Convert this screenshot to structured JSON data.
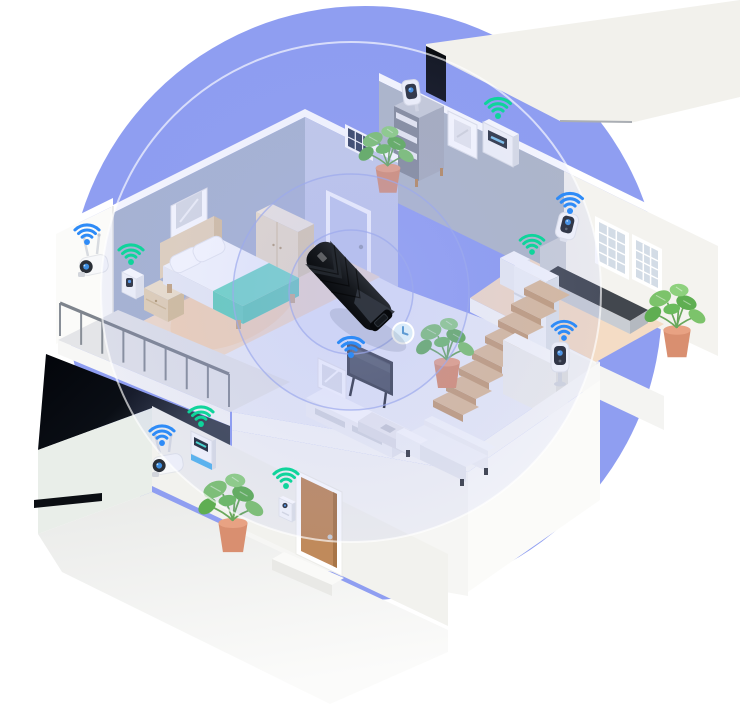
{
  "meta": {
    "type": "isometric-illustration",
    "subject": "smart home Wi-Fi coverage provided by a USB Wi-Fi adapter",
    "canvas": {
      "width": 740,
      "height": 720
    }
  },
  "palette": {
    "background": "#FFFFFF",
    "coverage_backdrop": "#8F9EF1",
    "coverage_tint": "#96A3F2",
    "wifi_blue": "#2E8BF7",
    "wifi_green": "#0FD49B",
    "adapter_body": "#15181D",
    "wall_gray": "#B1B9C6",
    "wall_blue": "#A9B5CF",
    "wall_lavender": "#C7CEE9",
    "wall_offwhite": "#F2F1EC",
    "floor_main": "#ECEEF6",
    "floor_wood": "#F5DEC7",
    "floor_kitchen": "#F4DCC5",
    "accent_teal": "#6FD9C3",
    "plant_green": "#7CC36B",
    "pot_terracotta": "#D98F70",
    "stair_tan": "#D9B897",
    "door_brown": "#C08A5B",
    "clock_face": "#D9EAF9"
  },
  "hero_device": {
    "id": "usb-wifi-adapter",
    "label": "USB Wi-Fi adapter",
    "position": {
      "x": 349,
      "y": 286
    },
    "rotation_deg": 47
  },
  "coverage": {
    "backdrop": {
      "cx": 365,
      "cy": 303,
      "r": 297
    },
    "center": {
      "x": 351,
      "y": 292
    },
    "ring_radii": [
      62,
      118
    ],
    "outer_radius": 250
  },
  "wall_clock": {
    "x": 403,
    "y": 333,
    "r": 10.5
  },
  "stairs": {
    "count": 8,
    "origin": {
      "x": 449,
      "y": 392
    },
    "step_dx": 13,
    "step_dy": -16
  },
  "balcony_railing": {
    "x0": 60,
    "y0": 336,
    "x1": 229,
    "y1": 407,
    "posts": 9,
    "height": 33
  },
  "devices": [
    {
      "id": "balcony-outdoor-camera",
      "label": "outdoor security camera",
      "room": "balcony",
      "wifi": "blue",
      "wifi_x": 87,
      "wifi_y": 242,
      "scale": 0.92
    },
    {
      "id": "balcony-motion-sensor",
      "label": "motion sensor",
      "room": "balcony",
      "wifi": "green",
      "wifi_x": 131,
      "wifi_y": 262,
      "scale": 0.92
    },
    {
      "id": "shelf-indoor-camera",
      "label": "indoor camera on shelf",
      "room": "upper-landing",
      "wifi": null
    },
    {
      "id": "wall-keypad",
      "label": "smart thermostat keypad",
      "room": "upper-landing",
      "wifi": "green",
      "wifi_x": 498,
      "wifi_y": 116,
      "scale": 0.95
    },
    {
      "id": "kitchen-corner-camera",
      "label": "security camera",
      "room": "kitchen",
      "wifi": "blue",
      "wifi_x": 570,
      "wifi_y": 211,
      "scale": 0.95
    },
    {
      "id": "refrigerator",
      "label": "smart refrigerator",
      "room": "kitchen",
      "wifi": "green",
      "wifi_x": 532,
      "wifi_y": 252,
      "scale": 0.9
    },
    {
      "id": "stair-ledge-camera",
      "label": "indoor camera on ledge",
      "room": "living-room",
      "wifi": "blue",
      "wifi_x": 564,
      "wifi_y": 338,
      "scale": 0.9
    },
    {
      "id": "smart-tv",
      "label": "smart TV",
      "room": "living-room",
      "wifi": "blue",
      "wifi_x": 351,
      "wifi_y": 355,
      "scale": 0.95
    },
    {
      "id": "entrance-outdoor-camera",
      "label": "outdoor security camera",
      "room": "entrance",
      "wifi": "blue",
      "wifi_x": 162,
      "wifi_y": 443,
      "scale": 0.92
    },
    {
      "id": "entrance-alarm-panel",
      "label": "smart alarm panel",
      "room": "entrance",
      "wifi": "green",
      "wifi_x": 201,
      "wifi_y": 424,
      "scale": 0.92
    },
    {
      "id": "video-doorbell",
      "label": "video doorbell",
      "room": "entrance",
      "wifi": "green",
      "wifi_x": 286,
      "wifi_y": 486,
      "scale": 0.92
    }
  ],
  "rooms": [
    {
      "id": "bedroom",
      "contents": [
        "double bed with teal blanket",
        "two pillows",
        "headboard",
        "nightstand",
        "wardrobe",
        "wall picture frame",
        "dark window"
      ]
    },
    {
      "id": "hallway",
      "contents": [
        "bedroom door",
        "wall clock",
        "USB Wi-Fi adapter",
        "potted plant",
        "staircase"
      ]
    },
    {
      "id": "upper-landing",
      "contents": [
        "shelf unit",
        "indoor camera on shelf",
        "framed picture",
        "wall keypad",
        "dark doorway",
        "potted plant"
      ]
    },
    {
      "id": "kitchen",
      "contents": [
        "refrigerator",
        "wall cabinet",
        "counter with dark top",
        "two windows",
        "potted plant",
        "corner security camera"
      ]
    },
    {
      "id": "living-room",
      "contents": [
        "TV",
        "media console",
        "leaning picture frame",
        "coffee table",
        "sofa",
        "indoor camera on ledge"
      ]
    },
    {
      "id": "balcony",
      "contents": [
        "metal railing",
        "outdoor camera",
        "motion sensor"
      ]
    },
    {
      "id": "entrance",
      "contents": [
        "front door",
        "door step",
        "video doorbell",
        "potted plant",
        "alarm panel",
        "outdoor camera",
        "ground path",
        "dark window slit"
      ]
    }
  ]
}
